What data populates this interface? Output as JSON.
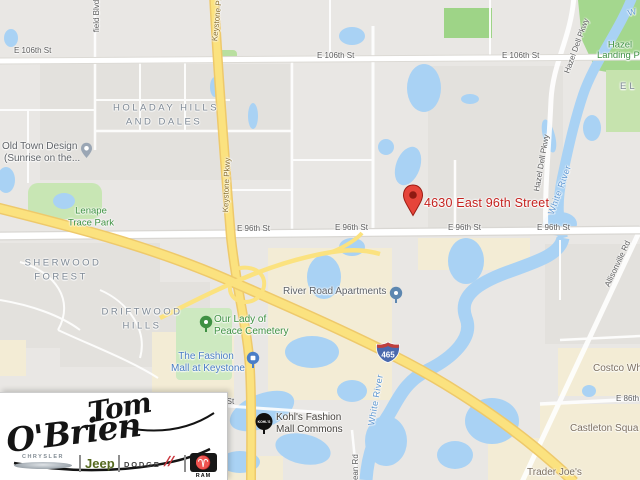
{
  "map": {
    "address": "4630 East 96th Street",
    "shield": "465",
    "streets": {
      "e106_a": "E 106th St",
      "e106_b": "E 106th St",
      "e106_c": "E 106th St",
      "e96_a": "E 96th St",
      "e96_b": "E 96th St",
      "e96_c": "E 96th St",
      "e96_d": "E 96th St",
      "e86": "E 86th S",
      "h_st_fragment": "h St",
      "keystone_a": "Keystone Pkwy",
      "keystone_b": "Keystone Pkwy",
      "hazel_dell_a": "Hazel Dell Pkwy",
      "hazel_dell_b": "Hazel Dell Pkwy",
      "field_blvd": "field Blvd",
      "dean_rd": "Dean Rd",
      "allisonville": "Allisonville Rd"
    },
    "water_labels": {
      "white_river_a": "White River",
      "white_river_b": "White River",
      "w_fragment": "W"
    },
    "neighborhoods": {
      "holaday_1": "Holaday Hills",
      "holaday_2": "and Dales",
      "sherwood_1": "Sherwood",
      "sherwood_2": "Forest",
      "driftwood_1": "Driftwood",
      "driftwood_2": "Hills",
      "el_fragment": "EL"
    },
    "parks": {
      "hazel_landing_1": "Hazel",
      "hazel_landing_2": "Landing Park",
      "lenape_1": "Lenape",
      "lenape_2": "Trace Park",
      "cemetery_1": "Our Lady of",
      "cemetery_2": "Peace Cemetery"
    },
    "pois": {
      "old_town_1": "Old Town Design",
      "old_town_2": "(Sunrise on the...",
      "river_road": "River Road Apartments",
      "fashion_mall_1": "The Fashion",
      "fashion_mall_2": "Mall at Keystone",
      "kohls_1": "Kohl's Fashion",
      "kohls_2": "Mall Commons",
      "kohls_icon_text": "KOHL'S",
      "castleton": "Castleton Squa",
      "trader_joes": "Trader Joe's",
      "costco": "Costco Wh"
    }
  },
  "logo": {
    "dealer_1": "Tom",
    "dealer_2": "O'Brien",
    "chrysler": "CHRYSLER",
    "jeep": "Jeep",
    "dodge": "DODGE",
    "dodge_slashes": "//",
    "ram_symbol": "♈",
    "ram": "RAM"
  },
  "colors": {
    "water": "#a9d2f4",
    "park": "#c8e6b4",
    "park_bright": "#a4d78e",
    "commercial": "#f3ecd5",
    "highway": "#fbe27f",
    "road": "#ffffff",
    "marker_red": "#e6453a",
    "address_red": "#c5221f",
    "interstate_blue": "#4a69ad",
    "interstate_red": "#c0403c",
    "jeep_green": "#55691f",
    "dodge_red": "#c9363d"
  }
}
